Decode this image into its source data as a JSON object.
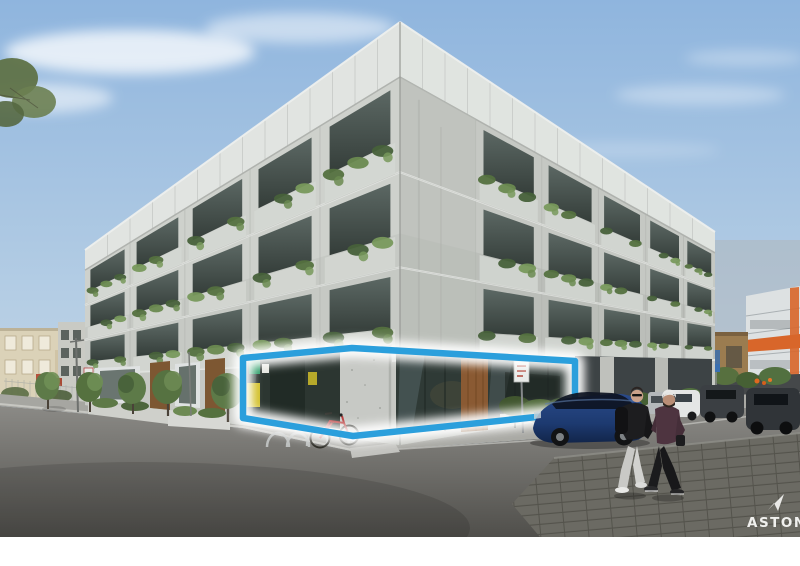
{
  "photo": {
    "subject": "corner apartment building with highlighted ground-floor retail space",
    "watermark": {
      "text": "ASTON",
      "icon": "arrow-up-right-icon",
      "color": "#f0f0ee"
    },
    "highlight": {
      "marks": "ground-floor-retail-space",
      "color": "#2b9fdc",
      "glow_color": "#ffffff"
    },
    "colors": {
      "sky": "#8fb5de",
      "sky_horizon": "#cfdde9",
      "concrete": "#ced1cc",
      "concrete_shade": "#b7bab5",
      "screen_panels": "#e1e4e1",
      "glass_shopfront": "#323c37",
      "timber_door": "#8a5a33",
      "foliage": "#5d7a48",
      "road": "#54534f",
      "sidewalk": "#a7a7a2",
      "foreground_car": "#20407a",
      "highlight_blue": "#2b9fdc"
    }
  }
}
